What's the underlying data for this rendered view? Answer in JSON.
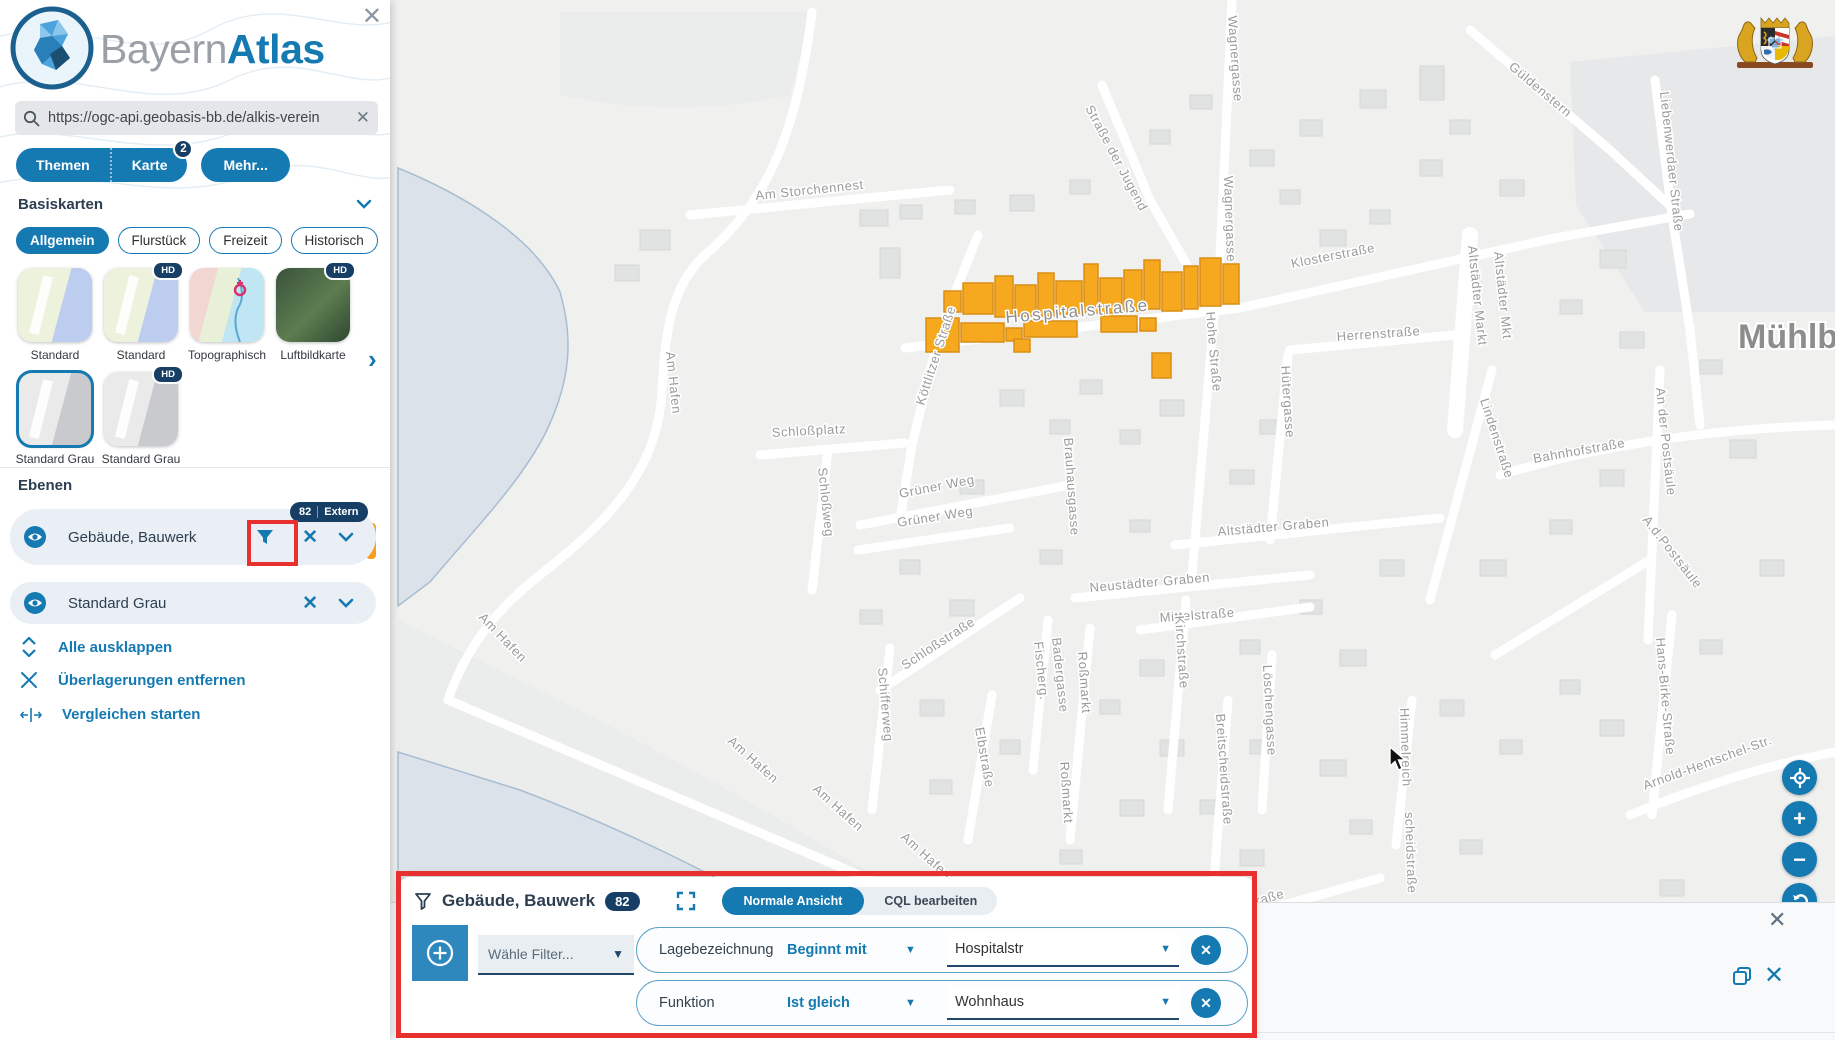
{
  "app": {
    "brand_light": "Bayern",
    "brand_bold": "Atlas"
  },
  "glyphs": {
    "close": "✕",
    "clear": "✕",
    "next": "›",
    "more_arrow": "›"
  },
  "search": {
    "value": "https://ogc-api.geobasis-bb.de/alkis-verein"
  },
  "tabs": {
    "themen": "Themen",
    "karte": "Karte",
    "karte_badge": "2",
    "mehr": "Mehr..."
  },
  "basemaps": {
    "heading": "Basiskarten",
    "chips": [
      "Allgemein",
      "Flurstück",
      "Freizeit",
      "Historisch"
    ],
    "thumbs": [
      {
        "label": "Standard",
        "hd": ""
      },
      {
        "label": "Standard",
        "hd": "HD"
      },
      {
        "label": "Topographisch",
        "hd": ""
      },
      {
        "label": "Luftbildkarte",
        "hd": "HD"
      },
      {
        "label": "Standard Grau",
        "hd": ""
      },
      {
        "label": "Standard Grau",
        "hd": "HD"
      }
    ]
  },
  "layers": {
    "heading": "Ebenen",
    "rows": [
      {
        "label": "Gebäude, Bauwerk",
        "badge_count": "82",
        "badge_text": "Extern"
      },
      {
        "label": "Standard Grau"
      }
    ],
    "actions": [
      {
        "label": "Alle ausklappen"
      },
      {
        "label": "Überlagerungen entfernen"
      },
      {
        "label": "Vergleichen starten"
      }
    ]
  },
  "filter_panel": {
    "title": "Gebäude, Bauwerk",
    "count": "82",
    "view_active": "Normale Ansicht",
    "view_inactive": "CQL bearbeiten",
    "add_filter_placeholder": "Wähle Filter...",
    "rows": [
      {
        "field": "Lagebezeichnung",
        "operator": "Beginnt mit",
        "value": "Hospitalstr"
      },
      {
        "field": "Funktion",
        "operator": "Ist gleich",
        "value": "Wohnhaus"
      }
    ]
  },
  "map": {
    "city_label": "Mühlberg",
    "street_labels": [
      {
        "t": "Wagnergasse",
        "x": 1228,
        "y": 16,
        "r": 86
      },
      {
        "t": "Wagnergasse",
        "x": 1224,
        "y": 176,
        "r": 88
      },
      {
        "t": "Straße der Jugend",
        "x": 1085,
        "y": 108,
        "r": 62
      },
      {
        "t": "Am Storchennest",
        "x": 756,
        "y": 200,
        "r": -6
      },
      {
        "t": "Güldenstern",
        "x": 1508,
        "y": 68,
        "r": 40
      },
      {
        "t": "Liebenwerdaer Straße",
        "x": 1660,
        "y": 92,
        "r": 84
      },
      {
        "t": "Klosterstraße",
        "x": 1292,
        "y": 268,
        "r": -11
      },
      {
        "t": "Altstädter Markt",
        "x": 1468,
        "y": 246,
        "r": 84
      },
      {
        "t": "Altstädter Mkt",
        "x": 1494,
        "y": 252,
        "r": 84
      },
      {
        "t": "Herrenstraße",
        "x": 1337,
        "y": 341,
        "r": -4
      },
      {
        "t": "Köttlitzer Straße",
        "x": 924,
        "y": 406,
        "r": -72
      },
      {
        "t": "Hospitalstraße",
        "x": 1006,
        "y": 323,
        "r": -5,
        "big": true
      },
      {
        "t": "Hohe Straße",
        "x": 1206,
        "y": 312,
        "r": 85
      },
      {
        "t": "Hütergasse",
        "x": 1281,
        "y": 366,
        "r": 86
      },
      {
        "t": "Lindenstraße",
        "x": 1480,
        "y": 400,
        "r": 72
      },
      {
        "t": "Bahnhofstraße",
        "x": 1534,
        "y": 463,
        "r": -10
      },
      {
        "t": "Schloßplatz",
        "x": 772,
        "y": 437,
        "r": -3
      },
      {
        "t": "Brauhausgasse",
        "x": 1064,
        "y": 438,
        "r": 86
      },
      {
        "t": "Grüner Weg",
        "x": 900,
        "y": 498,
        "r": -11
      },
      {
        "t": "Grüner Weg",
        "x": 898,
        "y": 527,
        "r": -9
      },
      {
        "t": "Altstädter Graben",
        "x": 1218,
        "y": 536,
        "r": -5
      },
      {
        "t": "An der Postsäule",
        "x": 1656,
        "y": 388,
        "r": 84
      },
      {
        "t": "A.d.Postsäule",
        "x": 1642,
        "y": 520,
        "r": 52
      },
      {
        "t": "Schloßweg",
        "x": 818,
        "y": 468,
        "r": 84
      },
      {
        "t": "Neustädter Graben",
        "x": 1090,
        "y": 592,
        "r": -5
      },
      {
        "t": "Mittelstraße",
        "x": 1160,
        "y": 622,
        "r": -4
      },
      {
        "t": "Am Hafen",
        "x": 666,
        "y": 352,
        "r": 84
      },
      {
        "t": "Schloßstraße",
        "x": 905,
        "y": 670,
        "r": -33
      },
      {
        "t": "Fischerg.",
        "x": 1034,
        "y": 642,
        "r": 84
      },
      {
        "t": "Badergasse",
        "x": 1052,
        "y": 638,
        "r": 84
      },
      {
        "t": "Roßmarkt",
        "x": 1078,
        "y": 652,
        "r": 86
      },
      {
        "t": "Roßmarkt",
        "x": 1060,
        "y": 762,
        "r": 86
      },
      {
        "t": "Kirchstraße",
        "x": 1175,
        "y": 616,
        "r": 86
      },
      {
        "t": "Löschengasse",
        "x": 1263,
        "y": 665,
        "r": 87
      },
      {
        "t": "Breitscheidstraße",
        "x": 1216,
        "y": 714,
        "r": 86
      },
      {
        "t": "Breitscheidstraße",
        "x": 1178,
        "y": 928,
        "r": -16
      },
      {
        "t": "Schifferweg",
        "x": 878,
        "y": 668,
        "r": 85
      },
      {
        "t": "Elbstraße",
        "x": 975,
        "y": 728,
        "r": 80
      },
      {
        "t": "Himmelreich",
        "x": 1400,
        "y": 708,
        "r": 88
      },
      {
        "t": "Hans-Birke-Straße",
        "x": 1656,
        "y": 638,
        "r": 85
      },
      {
        "t": "Arnold-Hentschel-Str.",
        "x": 1645,
        "y": 790,
        "r": -20
      },
      {
        "t": "scheidstraße",
        "x": 1405,
        "y": 812,
        "r": 88
      },
      {
        "t": "Am Hafen",
        "x": 478,
        "y": 618,
        "r": 46
      },
      {
        "t": "Am Hafen",
        "x": 727,
        "y": 742,
        "r": 42
      },
      {
        "t": "Am Hafen",
        "x": 812,
        "y": 790,
        "r": 42
      },
      {
        "t": "Am Hafen",
        "x": 900,
        "y": 838,
        "r": 42
      }
    ],
    "highlighted_buildings": [
      [
        944,
        291,
        17,
        21
      ],
      [
        963,
        283,
        30,
        31
      ],
      [
        995,
        276,
        18,
        41
      ],
      [
        1015,
        285,
        21,
        31
      ],
      [
        1038,
        273,
        16,
        43
      ],
      [
        1056,
        281,
        26,
        33
      ],
      [
        1084,
        264,
        14,
        49
      ],
      [
        1100,
        278,
        22,
        35
      ],
      [
        1124,
        270,
        18,
        41
      ],
      [
        1144,
        260,
        16,
        49
      ],
      [
        1162,
        272,
        20,
        39
      ],
      [
        1184,
        266,
        14,
        43
      ],
      [
        1200,
        258,
        21,
        48
      ],
      [
        1223,
        264,
        16,
        40
      ],
      [
        926,
        318,
        33,
        34
      ],
      [
        961,
        323,
        43,
        19
      ],
      [
        1006,
        328,
        16,
        13
      ],
      [
        1024,
        321,
        53,
        16
      ],
      [
        1014,
        339,
        16,
        13
      ],
      [
        1101,
        316,
        36,
        16
      ],
      [
        1140,
        318,
        16,
        13
      ],
      [
        1152,
        353,
        19,
        25
      ]
    ]
  },
  "colors": {
    "accent": "#1579b2",
    "badge_navy": "#173f66",
    "highlight_orange": "#f6a01e",
    "annotation_red": "#e8312e"
  }
}
